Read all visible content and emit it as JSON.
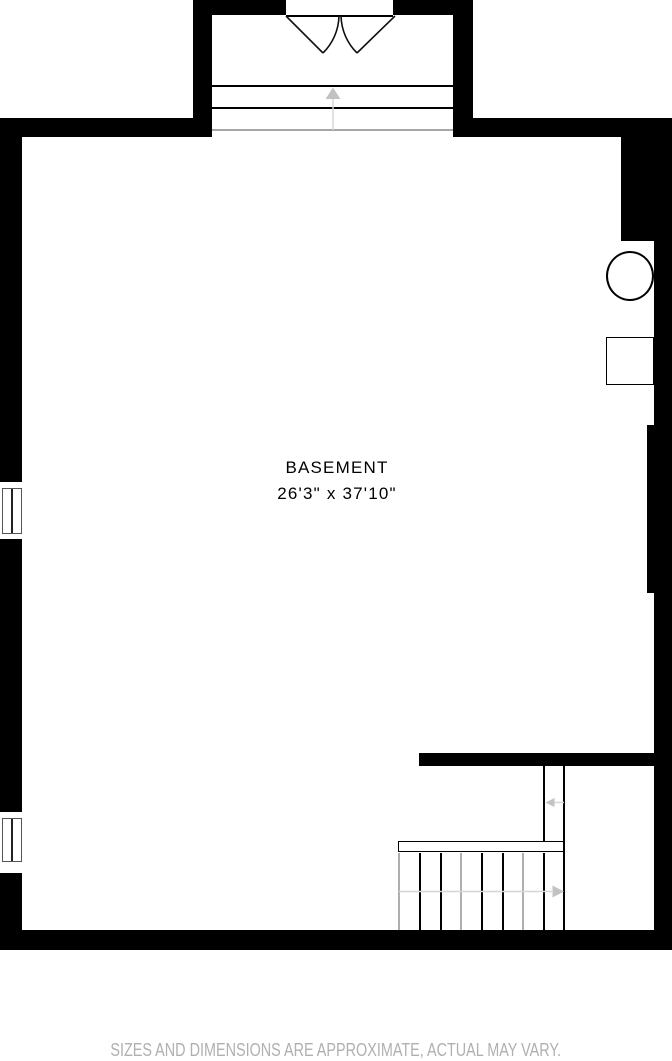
{
  "floor_plan": {
    "room": {
      "label": "BASEMENT",
      "dimensions": "26'3\" x 37'10\""
    },
    "disclaimer": "SIZES AND DIMENSIONS ARE APPROXIMATE, ACTUAL MAY VARY.",
    "colors": {
      "wall": "#000000",
      "floor": "#ffffff",
      "line": "#000000",
      "annotation_line": "#d6d6d6",
      "annotation_arrow": "#c2c2c2",
      "threshold": "#a6a6a6",
      "stair_gray": "#aeaeae",
      "disclaimer_text": "#b0b0b0"
    }
  }
}
